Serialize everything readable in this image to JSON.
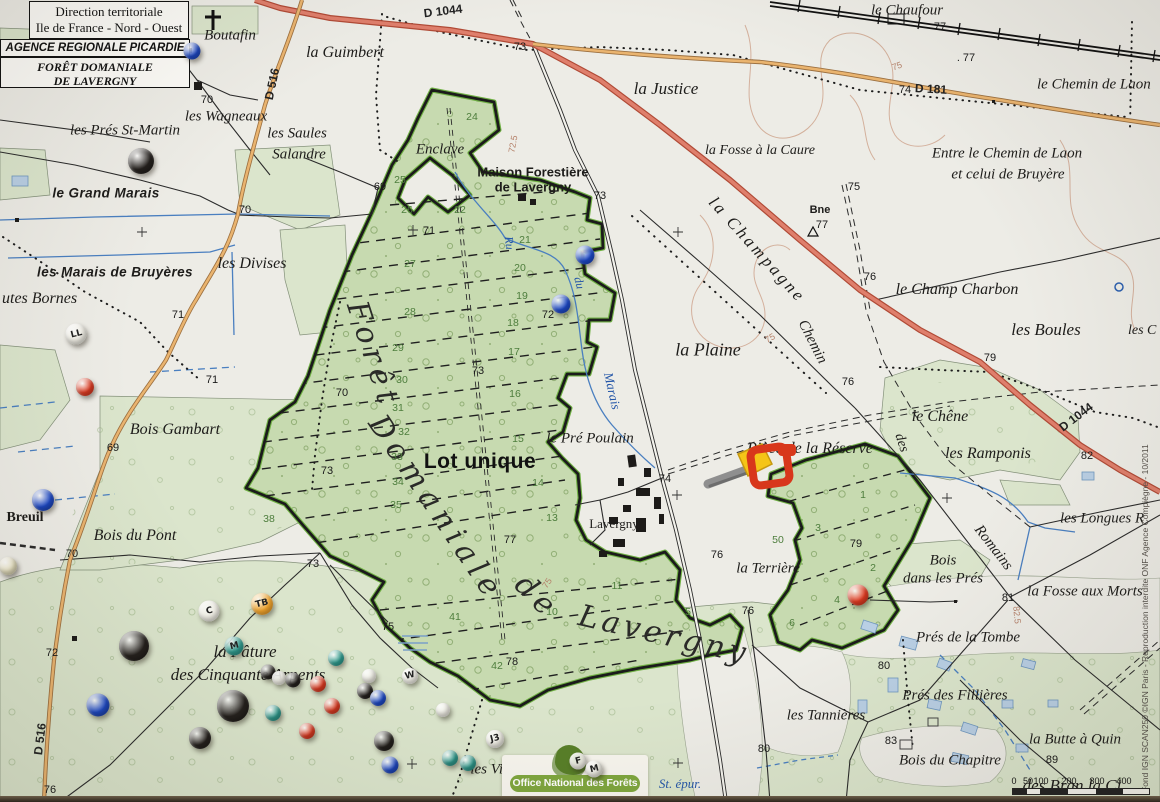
{
  "header": {
    "line1": "Direction territoriale",
    "line2": "Ile de France - Nord - Ouest",
    "line3": "AGENCE REGIONALE PICARDIE",
    "line4": "FORÊT DOMANIALE",
    "line5": "DE LAVERGNY"
  },
  "onf": {
    "label": "Office National des Forêts"
  },
  "scale": {
    "ticks": [
      "0",
      "50",
      "100",
      "200",
      "300",
      "400"
    ]
  },
  "copyright": "Fond IGN SCAN250 ©IGN Paris - Reproduction interdite ONF Agence Compiègne - 10/2011",
  "map": {
    "big_labels": [
      {
        "t": "Forêt",
        "x": 373,
        "y": 355,
        "c": "big",
        "r": 72
      },
      {
        "t": "Domaniale",
        "x": 436,
        "y": 508,
        "c": "big",
        "r": 56
      },
      {
        "t": "de",
        "x": 537,
        "y": 597,
        "c": "big",
        "r": 45
      },
      {
        "t": "Lavergny",
        "x": 664,
        "y": 635,
        "c": "big",
        "r": 13,
        "ls": 4
      },
      {
        "t": "Lot unique",
        "x": 480,
        "y": 462,
        "c": "lot"
      }
    ],
    "place_labels": [
      {
        "t": "Boutafin",
        "x": 230,
        "y": 36
      },
      {
        "t": "la Guimbert",
        "x": 345,
        "y": 53,
        "s": 16
      },
      {
        "t": "les Wagneaux",
        "x": 226,
        "y": 117
      },
      {
        "t": "les Prés St-Martin",
        "x": 125,
        "y": 131
      },
      {
        "t": "les Saules",
        "x": 297,
        "y": 134
      },
      {
        "t": "Salandre",
        "x": 299,
        "y": 155
      },
      {
        "t": "le Grand Marais",
        "x": 106,
        "y": 193,
        "c": "marsh"
      },
      {
        "t": "les Marais de Bruyères",
        "x": 115,
        "y": 272,
        "c": "marsh"
      },
      {
        "t": "utes Bornes",
        "x": 2,
        "y": 299,
        "a": "l",
        "s": 16
      },
      {
        "t": "les Divises",
        "x": 252,
        "y": 264,
        "s": 16
      },
      {
        "t": "Enclave",
        "x": 440,
        "y": 150
      },
      {
        "t": "Maison Forestière",
        "x": 533,
        "y": 172,
        "c": "bsans"
      },
      {
        "t": "de Lavergny",
        "x": 533,
        "y": 187,
        "c": "bsans"
      },
      {
        "t": "la Justice",
        "x": 666,
        "y": 89,
        "s": 17
      },
      {
        "t": "la Fosse à la Caure",
        "x": 760,
        "y": 151,
        "s": 14
      },
      {
        "t": "le Chaufour",
        "x": 907,
        "y": 11,
        "s": 15
      },
      {
        "t": "le Chemin de Laon",
        "x": 1037,
        "y": 85,
        "a": "l",
        "s": 15
      },
      {
        "t": "Entre le Chemin de Laon",
        "x": 1007,
        "y": 154,
        "s": 15
      },
      {
        "t": "et celui de Bruyère",
        "x": 1008,
        "y": 175,
        "s": 15
      },
      {
        "t": "Bne",
        "x": 820,
        "y": 210,
        "c": "bsans",
        "s": 11
      },
      {
        "t": "la Champagne",
        "x": 757,
        "y": 250,
        "r": 48,
        "s": 17,
        "ls": 3
      },
      {
        "t": "Chemin",
        "x": 812,
        "y": 342,
        "r": 63,
        "s": 15
      },
      {
        "t": "le Champ Charbon",
        "x": 957,
        "y": 290,
        "s": 16
      },
      {
        "t": "les Boules",
        "x": 1046,
        "y": 330,
        "s": 17
      },
      {
        "t": "les C",
        "x": 1128,
        "y": 331,
        "a": "l",
        "s": 14
      },
      {
        "t": "la Plaine",
        "x": 708,
        "y": 350,
        "s": 18
      },
      {
        "t": "le Chêne",
        "x": 940,
        "y": 417,
        "s": 16
      },
      {
        "t": "les Ramponis",
        "x": 988,
        "y": 454,
        "s": 16
      },
      {
        "t": "des",
        "x": 901,
        "y": 443,
        "r": 72,
        "s": 14
      },
      {
        "t": "Romains",
        "x": 993,
        "y": 548,
        "r": 52,
        "s": 15
      },
      {
        "t": "les Longues R",
        "x": 1060,
        "y": 519,
        "a": "l",
        "s": 15
      },
      {
        "t": "Bois",
        "x": 943,
        "y": 561,
        "s": 15
      },
      {
        "t": "dans les Prés",
        "x": 943,
        "y": 579,
        "s": 15
      },
      {
        "t": "la Fosse aux Morts",
        "x": 1085,
        "y": 592,
        "s": 15
      },
      {
        "t": "Bois Gambart",
        "x": 175,
        "y": 430,
        "s": 16
      },
      {
        "t": "Bois du Pont",
        "x": 135,
        "y": 536,
        "s": 16
      },
      {
        "t": "Breuil",
        "x": 25,
        "y": 518,
        "c": "bserif"
      },
      {
        "t": "le Pré Poulain",
        "x": 590,
        "y": 439,
        "s": 15
      },
      {
        "t": "Pièce de la Réserve",
        "x": 810,
        "y": 449,
        "s": 16
      },
      {
        "t": "Lavergny",
        "x": 614,
        "y": 524,
        "c": "upright",
        "s": 13
      },
      {
        "t": "la Terrière",
        "x": 768,
        "y": 569,
        "s": 15
      },
      {
        "t": "Prés de la Tombe",
        "x": 968,
        "y": 638,
        "s": 15
      },
      {
        "t": "Prés des Fillières",
        "x": 955,
        "y": 696,
        "s": 15
      },
      {
        "t": "la Butte à Quin",
        "x": 1075,
        "y": 740,
        "s": 15
      },
      {
        "t": "Bois du Chapitre",
        "x": 950,
        "y": 761,
        "s": 15
      },
      {
        "t": "les Tannières",
        "x": 826,
        "y": 716,
        "s": 15
      },
      {
        "t": "la Pâture",
        "x": 245,
        "y": 652,
        "s": 17
      },
      {
        "t": "des Cinquante Arpents",
        "x": 248,
        "y": 675,
        "s": 17
      },
      {
        "t": "les Vie",
        "x": 490,
        "y": 770,
        "s": 15
      },
      {
        "t": "St. épur.",
        "x": 680,
        "y": 784,
        "c": "water",
        "s": 13
      },
      {
        "t": "des Bran la Ci",
        "x": 1072,
        "y": 786,
        "s": 17
      }
    ],
    "road_labels": [
      {
        "t": "D 1044",
        "x": 443,
        "y": 11,
        "r": -7
      },
      {
        "t": "D 181",
        "x": 931,
        "y": 89,
        "r": 3
      },
      {
        "t": "D 516",
        "x": 272,
        "y": 84,
        "r": -78
      },
      {
        "t": "D 516",
        "x": 40,
        "y": 739,
        "r": -83
      },
      {
        "t": "D 1044",
        "x": 1076,
        "y": 417,
        "r": -37
      }
    ],
    "water_labels": [
      {
        "t": "Ru",
        "x": 509,
        "y": 243,
        "r": 84
      },
      {
        "t": "du",
        "x": 579,
        "y": 283,
        "r": 76
      },
      {
        "t": "Marais",
        "x": 612,
        "y": 391,
        "r": 77,
        "s": 13
      }
    ],
    "contour_labels": [
      {
        "t": "75",
        "x": 897,
        "y": 66,
        "r": -20
      },
      {
        "t": "72.5",
        "x": 513,
        "y": 144,
        "r": -80
      },
      {
        "t": "75",
        "x": 770,
        "y": 338,
        "r": -30
      },
      {
        "t": "75",
        "x": 547,
        "y": 583,
        "r": -55
      },
      {
        "t": "82.5",
        "x": 1017,
        "y": 615,
        "r": 85
      }
    ],
    "spot_heights": [
      {
        "t": "70",
        "x": 207,
        "y": 100
      },
      {
        "t": "73",
        "x": 520,
        "y": 47
      },
      {
        "t": "73",
        "x": 600,
        "y": 196
      },
      {
        "t": "71",
        "x": 429,
        "y": 231
      },
      {
        "t": "72",
        "x": 548,
        "y": 315
      },
      {
        "t": "73",
        "x": 478,
        "y": 371
      },
      {
        "t": "70",
        "x": 342,
        "y": 393
      },
      {
        "t": "73",
        "x": 327,
        "y": 471
      },
      {
        "t": "71",
        "x": 178,
        "y": 315
      },
      {
        "t": "70",
        "x": 245,
        "y": 210
      },
      {
        "t": "69",
        "x": 380,
        "y": 187
      },
      {
        "t": "69",
        "x": 113,
        "y": 448
      },
      {
        "t": "71",
        "x": 212,
        "y": 380
      },
      {
        "t": "70",
        "x": 72,
        "y": 554
      },
      {
        "t": "72",
        "x": 52,
        "y": 653
      },
      {
        "t": "76",
        "x": 50,
        "y": 790
      },
      {
        "t": "74",
        "x": 905,
        "y": 90
      },
      {
        "t": "77",
        "x": 940,
        "y": 27
      },
      {
        "t": ". 77",
        "x": 966,
        "y": 58
      },
      {
        "t": "75",
        "x": 854,
        "y": 187
      },
      {
        "t": "76",
        "x": 870,
        "y": 277
      },
      {
        "t": "76",
        "x": 848,
        "y": 382
      },
      {
        "t": "79",
        "x": 990,
        "y": 358
      },
      {
        "t": "82",
        "x": 1087,
        "y": 456
      },
      {
        "t": "77",
        "x": 822,
        "y": 225
      },
      {
        "t": "74",
        "x": 665,
        "y": 479
      },
      {
        "t": "76",
        "x": 717,
        "y": 555
      },
      {
        "t": "76",
        "x": 748,
        "y": 611
      },
      {
        "t": "79",
        "x": 856,
        "y": 544
      },
      {
        "t": "77",
        "x": 510,
        "y": 540
      },
      {
        "t": "78",
        "x": 512,
        "y": 662
      },
      {
        "t": "80",
        "x": 764,
        "y": 749
      },
      {
        "t": "80",
        "x": 884,
        "y": 666
      },
      {
        "t": "83",
        "x": 891,
        "y": 741
      },
      {
        "t": "81",
        "x": 1008,
        "y": 598
      },
      {
        "t": "89",
        "x": 1052,
        "y": 760
      },
      {
        "t": "75",
        "x": 388,
        "y": 627
      },
      {
        "t": "73",
        "x": 313,
        "y": 564
      }
    ],
    "parcel_numbers": [
      {
        "t": "24",
        "x": 472,
        "y": 117
      },
      {
        "t": "25",
        "x": 400,
        "y": 180
      },
      {
        "t": "26",
        "x": 407,
        "y": 210
      },
      {
        "t": "22",
        "x": 460,
        "y": 210
      },
      {
        "t": "27",
        "x": 410,
        "y": 264
      },
      {
        "t": "28",
        "x": 410,
        "y": 312
      },
      {
        "t": "29",
        "x": 398,
        "y": 348
      },
      {
        "t": "30",
        "x": 402,
        "y": 380
      },
      {
        "t": "31",
        "x": 398,
        "y": 408
      },
      {
        "t": "32",
        "x": 404,
        "y": 432
      },
      {
        "t": "33",
        "x": 397,
        "y": 457
      },
      {
        "t": "34",
        "x": 398,
        "y": 482
      },
      {
        "t": "35",
        "x": 396,
        "y": 505
      },
      {
        "t": "21",
        "x": 525,
        "y": 240
      },
      {
        "t": "20",
        "x": 520,
        "y": 268
      },
      {
        "t": "19",
        "x": 522,
        "y": 296
      },
      {
        "t": "18",
        "x": 513,
        "y": 323
      },
      {
        "t": "17",
        "x": 514,
        "y": 352
      },
      {
        "t": "16",
        "x": 515,
        "y": 394
      },
      {
        "t": "15",
        "x": 518,
        "y": 439
      },
      {
        "t": "14",
        "x": 538,
        "y": 483
      },
      {
        "t": "13",
        "x": 552,
        "y": 518
      },
      {
        "t": "11",
        "x": 617,
        "y": 586
      },
      {
        "t": "10",
        "x": 552,
        "y": 612
      },
      {
        "t": "41",
        "x": 455,
        "y": 617
      },
      {
        "t": "42",
        "x": 497,
        "y": 666
      },
      {
        "t": "5",
        "x": 688,
        "y": 612
      },
      {
        "t": "4",
        "x": 837,
        "y": 600
      },
      {
        "t": "6",
        "x": 792,
        "y": 623
      },
      {
        "t": "1",
        "x": 863,
        "y": 495
      },
      {
        "t": "3",
        "x": 818,
        "y": 528
      },
      {
        "t": "2",
        "x": 873,
        "y": 568
      },
      {
        "t": "50",
        "x": 778,
        "y": 540
      },
      {
        "t": "38",
        "x": 269,
        "y": 519
      }
    ]
  },
  "pin_colors": {
    "blue": "#1d49c8",
    "red": "#e03b22",
    "black": "#24201d",
    "white": "#f1efe6",
    "teal": "#2f9d90",
    "orange": "#f2a42c",
    "cream": "#e9e3c2"
  },
  "pins": [
    {
      "x": 192,
      "y": 51,
      "d": 17,
      "color": "blue"
    },
    {
      "x": 141,
      "y": 161,
      "d": 26,
      "color": "black"
    },
    {
      "x": 76,
      "y": 334,
      "d": 21,
      "color": "white",
      "label": "LL"
    },
    {
      "x": 85,
      "y": 387,
      "d": 18,
      "color": "red"
    },
    {
      "x": 43,
      "y": 500,
      "d": 22,
      "color": "blue"
    },
    {
      "x": 585,
      "y": 255,
      "d": 19,
      "color": "blue"
    },
    {
      "x": 561,
      "y": 304,
      "d": 19,
      "color": "blue"
    },
    {
      "x": 98,
      "y": 705,
      "d": 23,
      "color": "blue"
    },
    {
      "x": 858,
      "y": 595,
      "d": 21,
      "color": "red"
    },
    {
      "x": 209,
      "y": 611,
      "d": 21,
      "color": "white",
      "label": "C"
    },
    {
      "x": 262,
      "y": 604,
      "d": 22,
      "color": "orange",
      "label": "TB"
    },
    {
      "x": 234,
      "y": 646,
      "d": 19,
      "color": "teal",
      "label": "M"
    },
    {
      "x": 134,
      "y": 646,
      "d": 30,
      "color": "black"
    },
    {
      "x": 233,
      "y": 706,
      "d": 32,
      "color": "black"
    },
    {
      "x": 200,
      "y": 738,
      "d": 22,
      "color": "black"
    },
    {
      "x": 268,
      "y": 672,
      "d": 15,
      "color": "black"
    },
    {
      "x": 279,
      "y": 678,
      "d": 14,
      "color": "white"
    },
    {
      "x": 293,
      "y": 680,
      "d": 15,
      "color": "black"
    },
    {
      "x": 336,
      "y": 658,
      "d": 16,
      "color": "teal"
    },
    {
      "x": 318,
      "y": 684,
      "d": 16,
      "color": "red"
    },
    {
      "x": 332,
      "y": 706,
      "d": 16,
      "color": "red"
    },
    {
      "x": 273,
      "y": 713,
      "d": 16,
      "color": "teal"
    },
    {
      "x": 307,
      "y": 731,
      "d": 16,
      "color": "red"
    },
    {
      "x": 369,
      "y": 676,
      "d": 14,
      "color": "white"
    },
    {
      "x": 365,
      "y": 691,
      "d": 16,
      "color": "black"
    },
    {
      "x": 378,
      "y": 698,
      "d": 16,
      "color": "blue"
    },
    {
      "x": 384,
      "y": 741,
      "d": 20,
      "color": "black"
    },
    {
      "x": 390,
      "y": 765,
      "d": 17,
      "color": "blue"
    },
    {
      "x": 450,
      "y": 758,
      "d": 16,
      "color": "teal"
    },
    {
      "x": 468,
      "y": 763,
      "d": 16,
      "color": "teal"
    },
    {
      "x": 495,
      "y": 739,
      "d": 18,
      "color": "white",
      "label": "J3"
    },
    {
      "x": 578,
      "y": 761,
      "d": 17,
      "color": "white",
      "label": "F"
    },
    {
      "x": 594,
      "y": 769,
      "d": 17,
      "color": "white",
      "label": "M"
    },
    {
      "x": 410,
      "y": 676,
      "d": 16,
      "color": "white",
      "label": "W"
    },
    {
      "x": 443,
      "y": 710,
      "d": 14,
      "color": "white"
    },
    {
      "x": 8,
      "y": 566,
      "d": 18,
      "color": "cream"
    }
  ],
  "special_markers": {
    "chainsaw_marker": {
      "x": 700,
      "y": 438
    }
  }
}
